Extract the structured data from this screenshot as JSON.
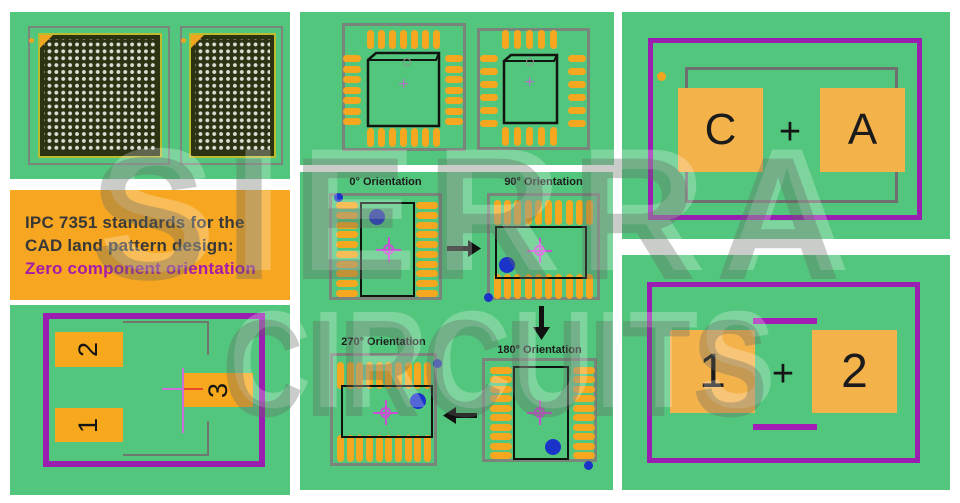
{
  "watermark": {
    "line1": "SIERRA",
    "line2": "CIRCUITS"
  },
  "title_box": {
    "line1": "IPC 7351 standards for the",
    "line2": "CAD land pattern design:",
    "line3": "Zero component orientation"
  },
  "colors": {
    "panel_green": "#52c67d",
    "pad_orange": "#f5a71f",
    "big_pad_orange": "#f4b24b",
    "title_box_orange": "#f6a620",
    "purple_border": "#9a1eaf",
    "magenta_crosshair": "#cb4fd6",
    "blue_marker": "#1c33c9",
    "title_accent": "#a51ba9",
    "bga_body": "#2b3312",
    "bga_border": "#b9bd2f"
  },
  "qfp_panel": {
    "left": {
      "top": 7,
      "bottom": 7,
      "left": 7,
      "right": 7
    },
    "right": {
      "top": 5,
      "bottom": 5,
      "left": 6,
      "right": 6
    }
  },
  "chip_panel": {
    "pads": [
      "2",
      "1",
      "3"
    ]
  },
  "orientation_panel": {
    "pads_per_side": 10,
    "steps": [
      {
        "label": "0° Orientation"
      },
      {
        "label": "90° Orientation"
      },
      {
        "label": "180° Orientation"
      },
      {
        "label": "270° Orientation"
      }
    ]
  },
  "ca_panel": {
    "left": "C",
    "op": "+",
    "right": "A"
  },
  "one_two_panel": {
    "left": "1",
    "op": "+",
    "right": "2"
  }
}
